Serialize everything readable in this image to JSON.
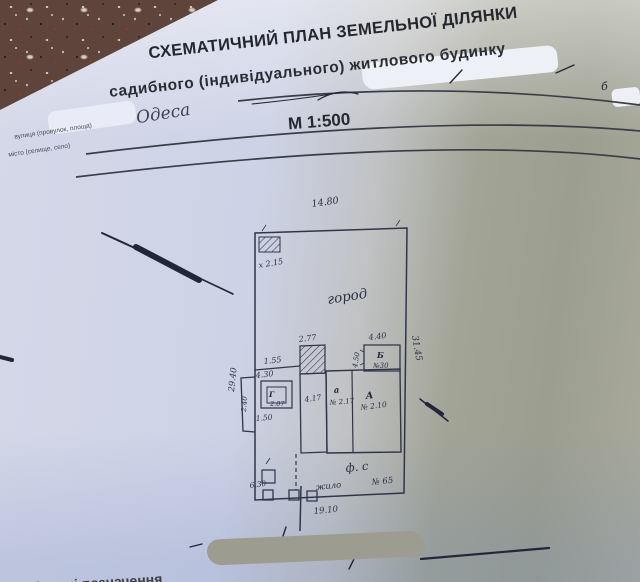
{
  "page": {
    "title_line1": "СХЕМАТИЧНИЙ ПЛАН ЗЕМЕЛЬНОЇ ДІЛЯНКИ",
    "title_line2": "садибного (індивідуального) житлового будинку",
    "scale": "М 1:500",
    "form_street": "вулиця (провулок, площа)",
    "form_city": "місто (селище, село)",
    "city_handwritten": "Одеса",
    "stray_letter": "б",
    "bottom_caption": "Умовні позначення"
  },
  "plan": {
    "top_dim": "14.80",
    "bottom_dim": "19.10",
    "right_dim": "31.45",
    "left_dim": "29.40",
    "corner_mark": "х 2.15",
    "garden": "город",
    "yard": "ф. с",
    "house_top_dim": "2.77",
    "shelf_dim": "1.55",
    "shed_dim": "4.30",
    "shed_letter": "Г",
    "shed_number": "2.07",
    "shed_bottom_dim": "1.50",
    "bump_dim": "2.40",
    "annex_dim": "4.17",
    "annex_letter": "а",
    "annex_number": "№ 2.17",
    "house_letter": "А",
    "house_number": "№ 2.10",
    "bldg_b_top_dim": "4.40",
    "bldg_b_side_dim": "4.50",
    "bldg_b_letter": "Б",
    "bldg_b_number": "№30",
    "gate_left_note": "6.30",
    "gate_mid_note": "жило",
    "gate_right_note": "№ 65"
  },
  "colors": {
    "ink": "#31354a",
    "pen_marks": "#23263a",
    "paper_light": "#d5d8e8",
    "paper_shadow": "#9c9e8f",
    "redaction_gray": "#9c9c90",
    "carpet": "#5e443a"
  }
}
